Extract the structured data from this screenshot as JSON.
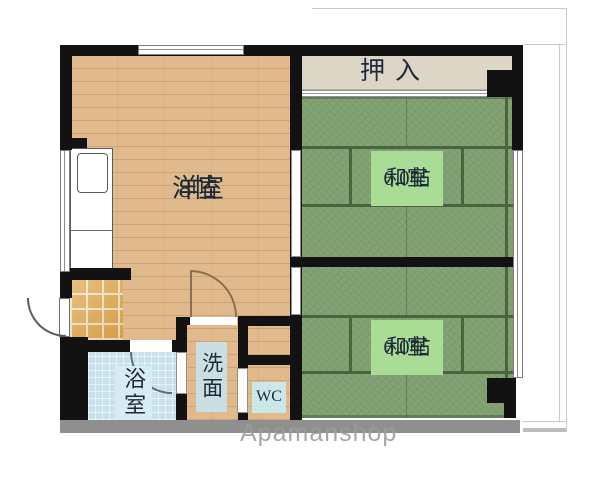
{
  "floorplan": {
    "watermark": "Apamanshop",
    "rooms": {
      "western_room": {
        "label": "洋室",
        "size": "8帖"
      },
      "japanese_room_upper": {
        "label": "和室",
        "size": "6.0帖"
      },
      "japanese_room_lower": {
        "label": "和室",
        "size": "6.0帖"
      },
      "closet": {
        "label": "押入"
      },
      "bathroom": {
        "label": "浴室"
      },
      "washroom": {
        "label": "洗面"
      },
      "toilet": {
        "label": "WC"
      }
    },
    "colors": {
      "wall": "#121212",
      "wood_floor": "#e0ba8d",
      "tatami": "#7e9f70",
      "tatami_label_bg": "#a9dd96",
      "closet_bg": "#dbd6c6",
      "bath_tile": "#c7e1ed",
      "genkan_tile": "#e1a84f",
      "label_panel_bg": "#cbe7e8",
      "text": "#1e2a38",
      "bottom_shadow": "#8f8f8f"
    }
  }
}
